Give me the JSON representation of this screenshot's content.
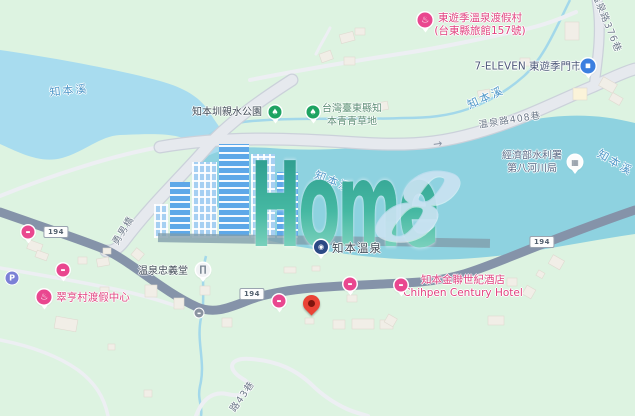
{
  "watermark": {
    "brand": "Home",
    "digit": "8"
  },
  "colors": {
    "background_green": "#DDF3E1",
    "water_upper": "#A8DCEF",
    "water_main": "#8ED2E0",
    "road_major": "#8593A9",
    "road_minor": "#EDEFF3",
    "poi_pink": "#E9478F",
    "pin_red": "#EA4335",
    "tree_green": "#1EA362",
    "store_blue": "#3C7FE0"
  },
  "map": {
    "route_badge_label": "194",
    "badges": [
      {
        "name": "route-194-badge-left",
        "x": 56,
        "y": 232
      },
      {
        "name": "route-194-badge-center",
        "x": 252,
        "y": 294
      },
      {
        "name": "route-194-badge-right",
        "x": 542,
        "y": 242
      }
    ],
    "labels": [
      {
        "name": "river-label-west",
        "text": "知本溪",
        "x": 69,
        "y": 91,
        "cls": "water",
        "rot": -5,
        "clickable": false
      },
      {
        "name": "park-label-qinshui",
        "text": "知本圳親水公園",
        "x": 227,
        "y": 113,
        "cls": "dark",
        "rot": 0,
        "clickable": true
      },
      {
        "name": "park-label-green-grass",
        "lines": [
          "台灣臺東縣知",
          "本青青草地"
        ],
        "x": 352,
        "y": 116,
        "cls": "park",
        "rot": 0,
        "clickable": true
      },
      {
        "name": "resort-label-toyugi",
        "lines": [
          "東遊季溫泉渡假村",
          "(台東縣旅館157號)"
        ],
        "x": 480,
        "y": 25,
        "cls": "pink",
        "rot": 0,
        "clickable": true
      },
      {
        "name": "store-label-7eleven",
        "text": "7-ELEVEN 東遊季門市",
        "x": 528,
        "y": 67,
        "cls": "store",
        "rot": 0,
        "clickable": true
      },
      {
        "name": "road-label-lane376",
        "text": "温泉路376巷",
        "x": 606,
        "y": 23,
        "cls": "road",
        "rot": 68,
        "clickable": false
      },
      {
        "name": "river-label-north",
        "text": "知本溪",
        "x": 486,
        "y": 98,
        "cls": "water",
        "rot": -24,
        "clickable": false
      },
      {
        "name": "road-label-lane408",
        "text": "温泉路408巷",
        "x": 510,
        "y": 121,
        "cls": "road",
        "rot": -9,
        "clickable": false
      },
      {
        "name": "gov-label-water-agency",
        "lines": [
          "經濟部水利署",
          "第八河川局"
        ],
        "x": 532,
        "y": 163,
        "cls": "gov",
        "rot": 0,
        "clickable": true
      },
      {
        "name": "river-label-east",
        "text": "知本溪",
        "x": 615,
        "y": 163,
        "cls": "water",
        "rot": 30,
        "clickable": false
      },
      {
        "name": "river-label-center",
        "text": "知本溪",
        "x": 333,
        "y": 182,
        "cls": "water under",
        "rot": 22,
        "clickable": false
      },
      {
        "name": "bridge-label-yongnan",
        "text": "勇男橋",
        "x": 124,
        "y": 231,
        "cls": "road",
        "rot": -58,
        "clickable": false
      },
      {
        "name": "temple-label-zhongyi",
        "text": "温泉忠義堂",
        "x": 163,
        "y": 272,
        "cls": "dark",
        "rot": 0,
        "clickable": true
      },
      {
        "name": "poi-label-zhiben-hotspring",
        "text": "知本溫泉",
        "x": 357,
        "y": 248,
        "cls": "dark big",
        "rot": 0,
        "clickable": true
      },
      {
        "name": "resort-label-cuiheng",
        "text": "翠亨村渡假中心",
        "x": 93,
        "y": 298,
        "cls": "pink",
        "rot": 0,
        "clickable": true
      },
      {
        "name": "hotel-label-century",
        "lines": [
          "知本金聯世紀酒店",
          "Chihpen Century Hotel"
        ],
        "x": 463,
        "y": 287,
        "cls": "pink",
        "rot": 0,
        "clickable": true
      },
      {
        "name": "road-label-lane43",
        "text": "路43巷",
        "x": 243,
        "y": 397,
        "cls": "road",
        "rot": -55,
        "clickable": false
      }
    ],
    "icons": [
      {
        "type": "tree",
        "name": "tree-icon",
        "x": 275,
        "y": 112
      },
      {
        "type": "tree",
        "name": "tree-icon",
        "x": 313,
        "y": 112
      },
      {
        "type": "onsen",
        "name": "hot-spring-icon",
        "x": 425,
        "y": 20
      },
      {
        "type": "store",
        "name": "convenience-store-icon",
        "x": 588,
        "y": 66
      },
      {
        "type": "gov",
        "name": "government-office-icon",
        "x": 575,
        "y": 162
      },
      {
        "type": "attraction",
        "name": "attraction-icon",
        "x": 321,
        "y": 247
      },
      {
        "type": "temple",
        "name": "temple-icon",
        "x": 203,
        "y": 270
      },
      {
        "type": "onsen",
        "name": "hot-spring-icon",
        "x": 44,
        "y": 297
      },
      {
        "type": "bed",
        "name": "lodging-icon",
        "x": 28,
        "y": 232
      },
      {
        "type": "bed",
        "name": "lodging-icon",
        "x": 63,
        "y": 270
      },
      {
        "type": "bed",
        "name": "lodging-icon",
        "x": 279,
        "y": 301
      },
      {
        "type": "bed",
        "name": "lodging-icon",
        "x": 350,
        "y": 284
      },
      {
        "type": "bed",
        "name": "lodging-icon",
        "x": 401,
        "y": 285
      },
      {
        "type": "parking",
        "name": "parking-icon",
        "x": 12,
        "y": 278
      },
      {
        "type": "bus",
        "name": "bus-stop-icon",
        "x": 199,
        "y": 313
      }
    ],
    "icon_glyphs": {
      "tree": "♠",
      "onsen": "♨",
      "bed": "▬",
      "store": "■",
      "gov": "▦",
      "temple": "∏",
      "attraction": "◉",
      "parking": "P",
      "bus": "▬"
    },
    "pin": {
      "x": 311,
      "y": 318
    },
    "oneway_arrow": {
      "glyph": "→",
      "x": 440,
      "y": 143
    }
  }
}
